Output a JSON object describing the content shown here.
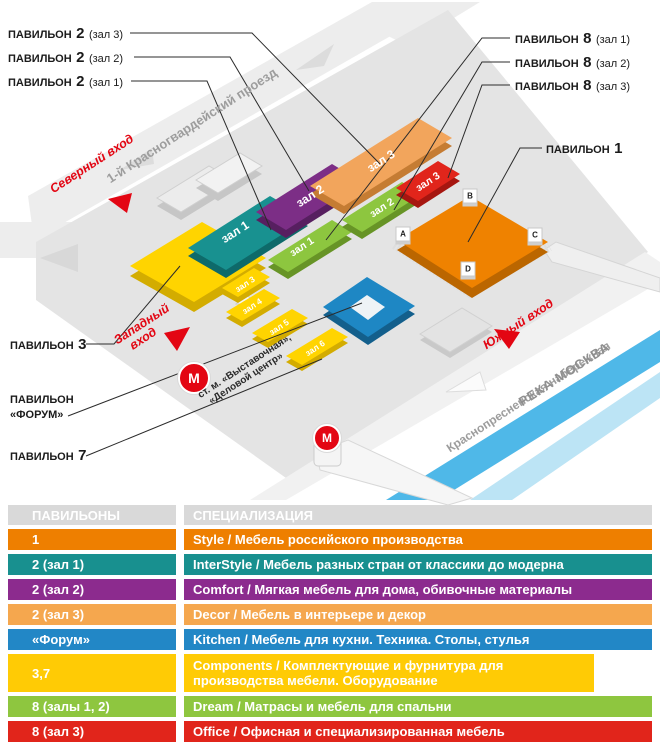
{
  "map": {
    "callouts": {
      "p2h3": {
        "prefix": "ПАВИЛЬОН",
        "num": "2",
        "suffix": "(зал 3)"
      },
      "p2h2": {
        "prefix": "ПАВИЛЬОН",
        "num": "2",
        "suffix": "(зал 2)"
      },
      "p2h1": {
        "prefix": "ПАВИЛЬОН",
        "num": "2",
        "suffix": "(зал 1)"
      },
      "p8h1": {
        "prefix": "ПАВИЛЬОН",
        "num": "8",
        "suffix": "(зал 1)"
      },
      "p8h2": {
        "prefix": "ПАВИЛЬОН",
        "num": "8",
        "suffix": "(зал 2)"
      },
      "p8h3": {
        "prefix": "ПАВИЛЬОН",
        "num": "8",
        "suffix": "(зал 3)"
      },
      "p1": {
        "prefix": "ПАВИЛЬОН",
        "num": "1"
      },
      "p3": {
        "prefix": "ПАВИЛЬОН",
        "num": "3"
      },
      "forum": {
        "line1": "ПАВИЛЬОН",
        "line2": "«ФОРУМ»"
      },
      "p7": {
        "prefix": "ПАВИЛЬОН",
        "num": "7"
      }
    },
    "entrances": {
      "north": "Северный вход",
      "west_line1": "Западный",
      "west_line2": "вход",
      "south": "Южный вход"
    },
    "streets": {
      "top": "1-й Красногвардейский проезд",
      "embankment": "Краснопресненская набережная",
      "river": "РЕКА МОСКВА"
    },
    "metro": {
      "symbol": "М",
      "station_line1": "ст. м. «Выставочная»,",
      "station_line2": "«Деловой центр»"
    },
    "halls": {
      "p2": [
        "зал 1",
        "зал 2",
        "зал 3"
      ],
      "p8": [
        "зал 1",
        "зал 2",
        "зал 3"
      ],
      "p7": [
        "зал 3",
        "зал 4",
        "зал 5",
        "зал 6"
      ]
    },
    "corners": [
      "A",
      "B",
      "C",
      "D"
    ]
  },
  "table": {
    "headers": [
      "ПАВИЛЬОНЫ",
      "СПЕЦИАЛИЗАЦИЯ"
    ],
    "rows": [
      {
        "pavilion": "1",
        "spec": "Style / Мебель российского производства",
        "color": "#ee7f00"
      },
      {
        "pavilion": "2 (зал 1)",
        "spec": "InterStyle / Мебель разных стран от классики до модерна",
        "color": "#18908f"
      },
      {
        "pavilion": "2 (зал 2)",
        "spec": "Comfort / Мягкая мебель для дома, обивочные материалы",
        "color": "#8c2b8e"
      },
      {
        "pavilion": "2 (зал 3)",
        "spec": "Decor / Мебель в интерьере и декор",
        "color": "#f5a74e"
      },
      {
        "pavilion": "«Форум»",
        "spec": "Kitchen / Мебель для кухни. Техника. Столы, стулья",
        "color": "#2287c6"
      },
      {
        "pavilion": "3,7",
        "spec": "Components / Комплектующие и фурнитура для производства мебели. Оборудование",
        "color": "#ffcb05"
      },
      {
        "pavilion": "8 (залы 1, 2)",
        "spec": "Dream / Матрасы и мебель для спальни",
        "color": "#8ec63f"
      },
      {
        "pavilion": "8 (зал 3)",
        "spec": "Office / Офисная и специализированная мебель",
        "color": "#e1251b"
      }
    ]
  },
  "colors": {
    "accent_red": "#e30613",
    "street_gray": "#ededed",
    "ground_gray": "#e4e4e4",
    "river_blue": "#4fb8e8"
  }
}
